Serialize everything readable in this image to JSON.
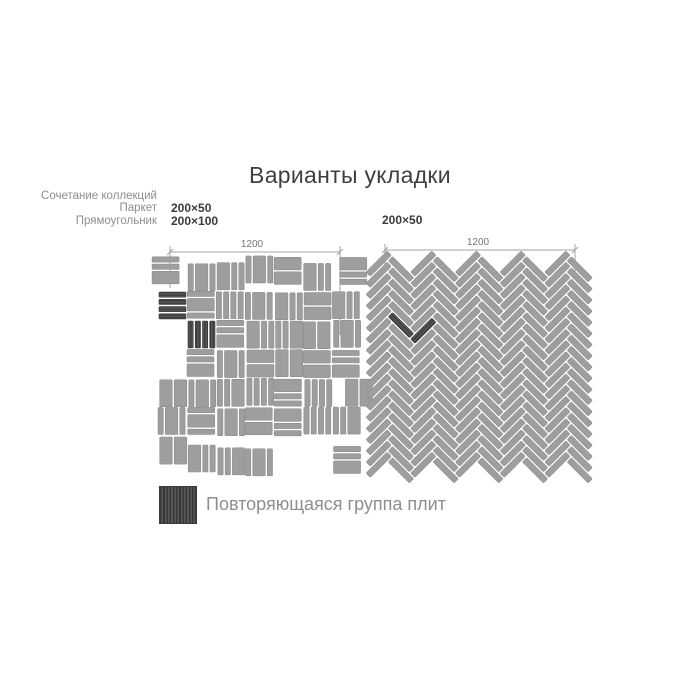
{
  "title": "Варианты укладки",
  "left_diagram": {
    "collection_labels": [
      "Сочетание коллекций",
      "Паркет",
      "Прямоугольник"
    ],
    "tile_sizes": [
      "200×50",
      "200×100"
    ],
    "dimension_label": "1200",
    "pattern_type": "mixed-parquet-basketweave"
  },
  "right_diagram": {
    "tile_size": "200×50",
    "dimension_label": "1200",
    "pattern_type": "herringbone-45deg"
  },
  "legend": {
    "label": "Повторяющаяся группа плит"
  },
  "colors": {
    "background": "#ffffff",
    "tile": "#9e9e9e",
    "tile_edge": "#8b8b8b",
    "highlight": "#4c4c4c",
    "highlight_dark_line": "#373737",
    "highlight_light_line": "#606060",
    "highlight_edge": "#333333",
    "dimension_line": "#a3a3a3",
    "dimension_text": "#757575",
    "gray_text": "#8e8e8e",
    "dark_text": "#3a3a3a"
  }
}
